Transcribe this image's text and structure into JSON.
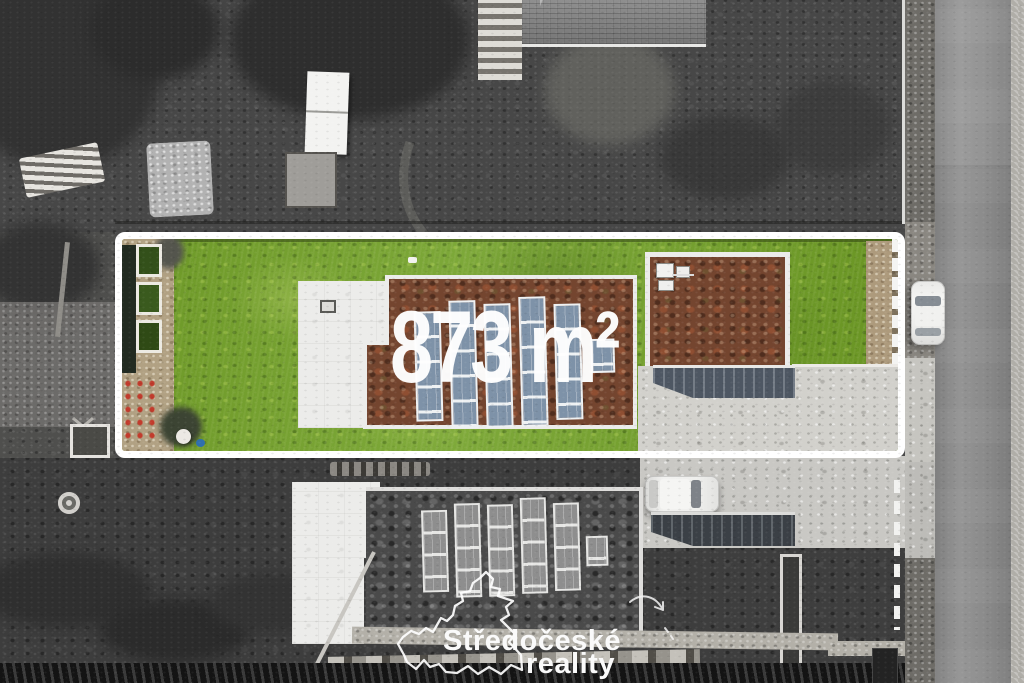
{
  "image": {
    "type": "aerial-drone-photo",
    "subject": "building plot highlighted in color over grayscale surroundings"
  },
  "plot": {
    "area_label": "873 m²",
    "area_value_m2": 873,
    "outline_color": "#ffffff",
    "colors": {
      "lawn": "#709c2b",
      "sedum_green_roof": "#74452f",
      "solar_panels": "#7e92a8",
      "flat_roof_white": "#ececea",
      "driveway_concrete": "#d0cfca",
      "entrance_stairs": "#4e5763",
      "gravel_border": "#b1a183"
    },
    "features": [
      "lawn",
      "raised garden beds",
      "house with white flat roof",
      "sedum green roof with solar panels",
      "garage green roof with hvac units",
      "concrete driveway",
      "entrance stairs"
    ]
  },
  "surroundings": {
    "style": "grayscale",
    "colors": {
      "road_asphalt": "#8d8d8d",
      "garden": "#454545",
      "concrete": "#c8c7c4"
    },
    "features": [
      "street with parked white car",
      "neighbor house with rooftop solar panels",
      "neighbor driveway with parked car",
      "hipped-roof house",
      "table-tennis table",
      "garden shed",
      "lumber piles",
      "hedges and trees"
    ]
  },
  "watermark": {
    "line1": "Středočeské",
    "line2": "reality",
    "emblem": "central-bohemia-region-outline",
    "color": "#fafafa"
  }
}
